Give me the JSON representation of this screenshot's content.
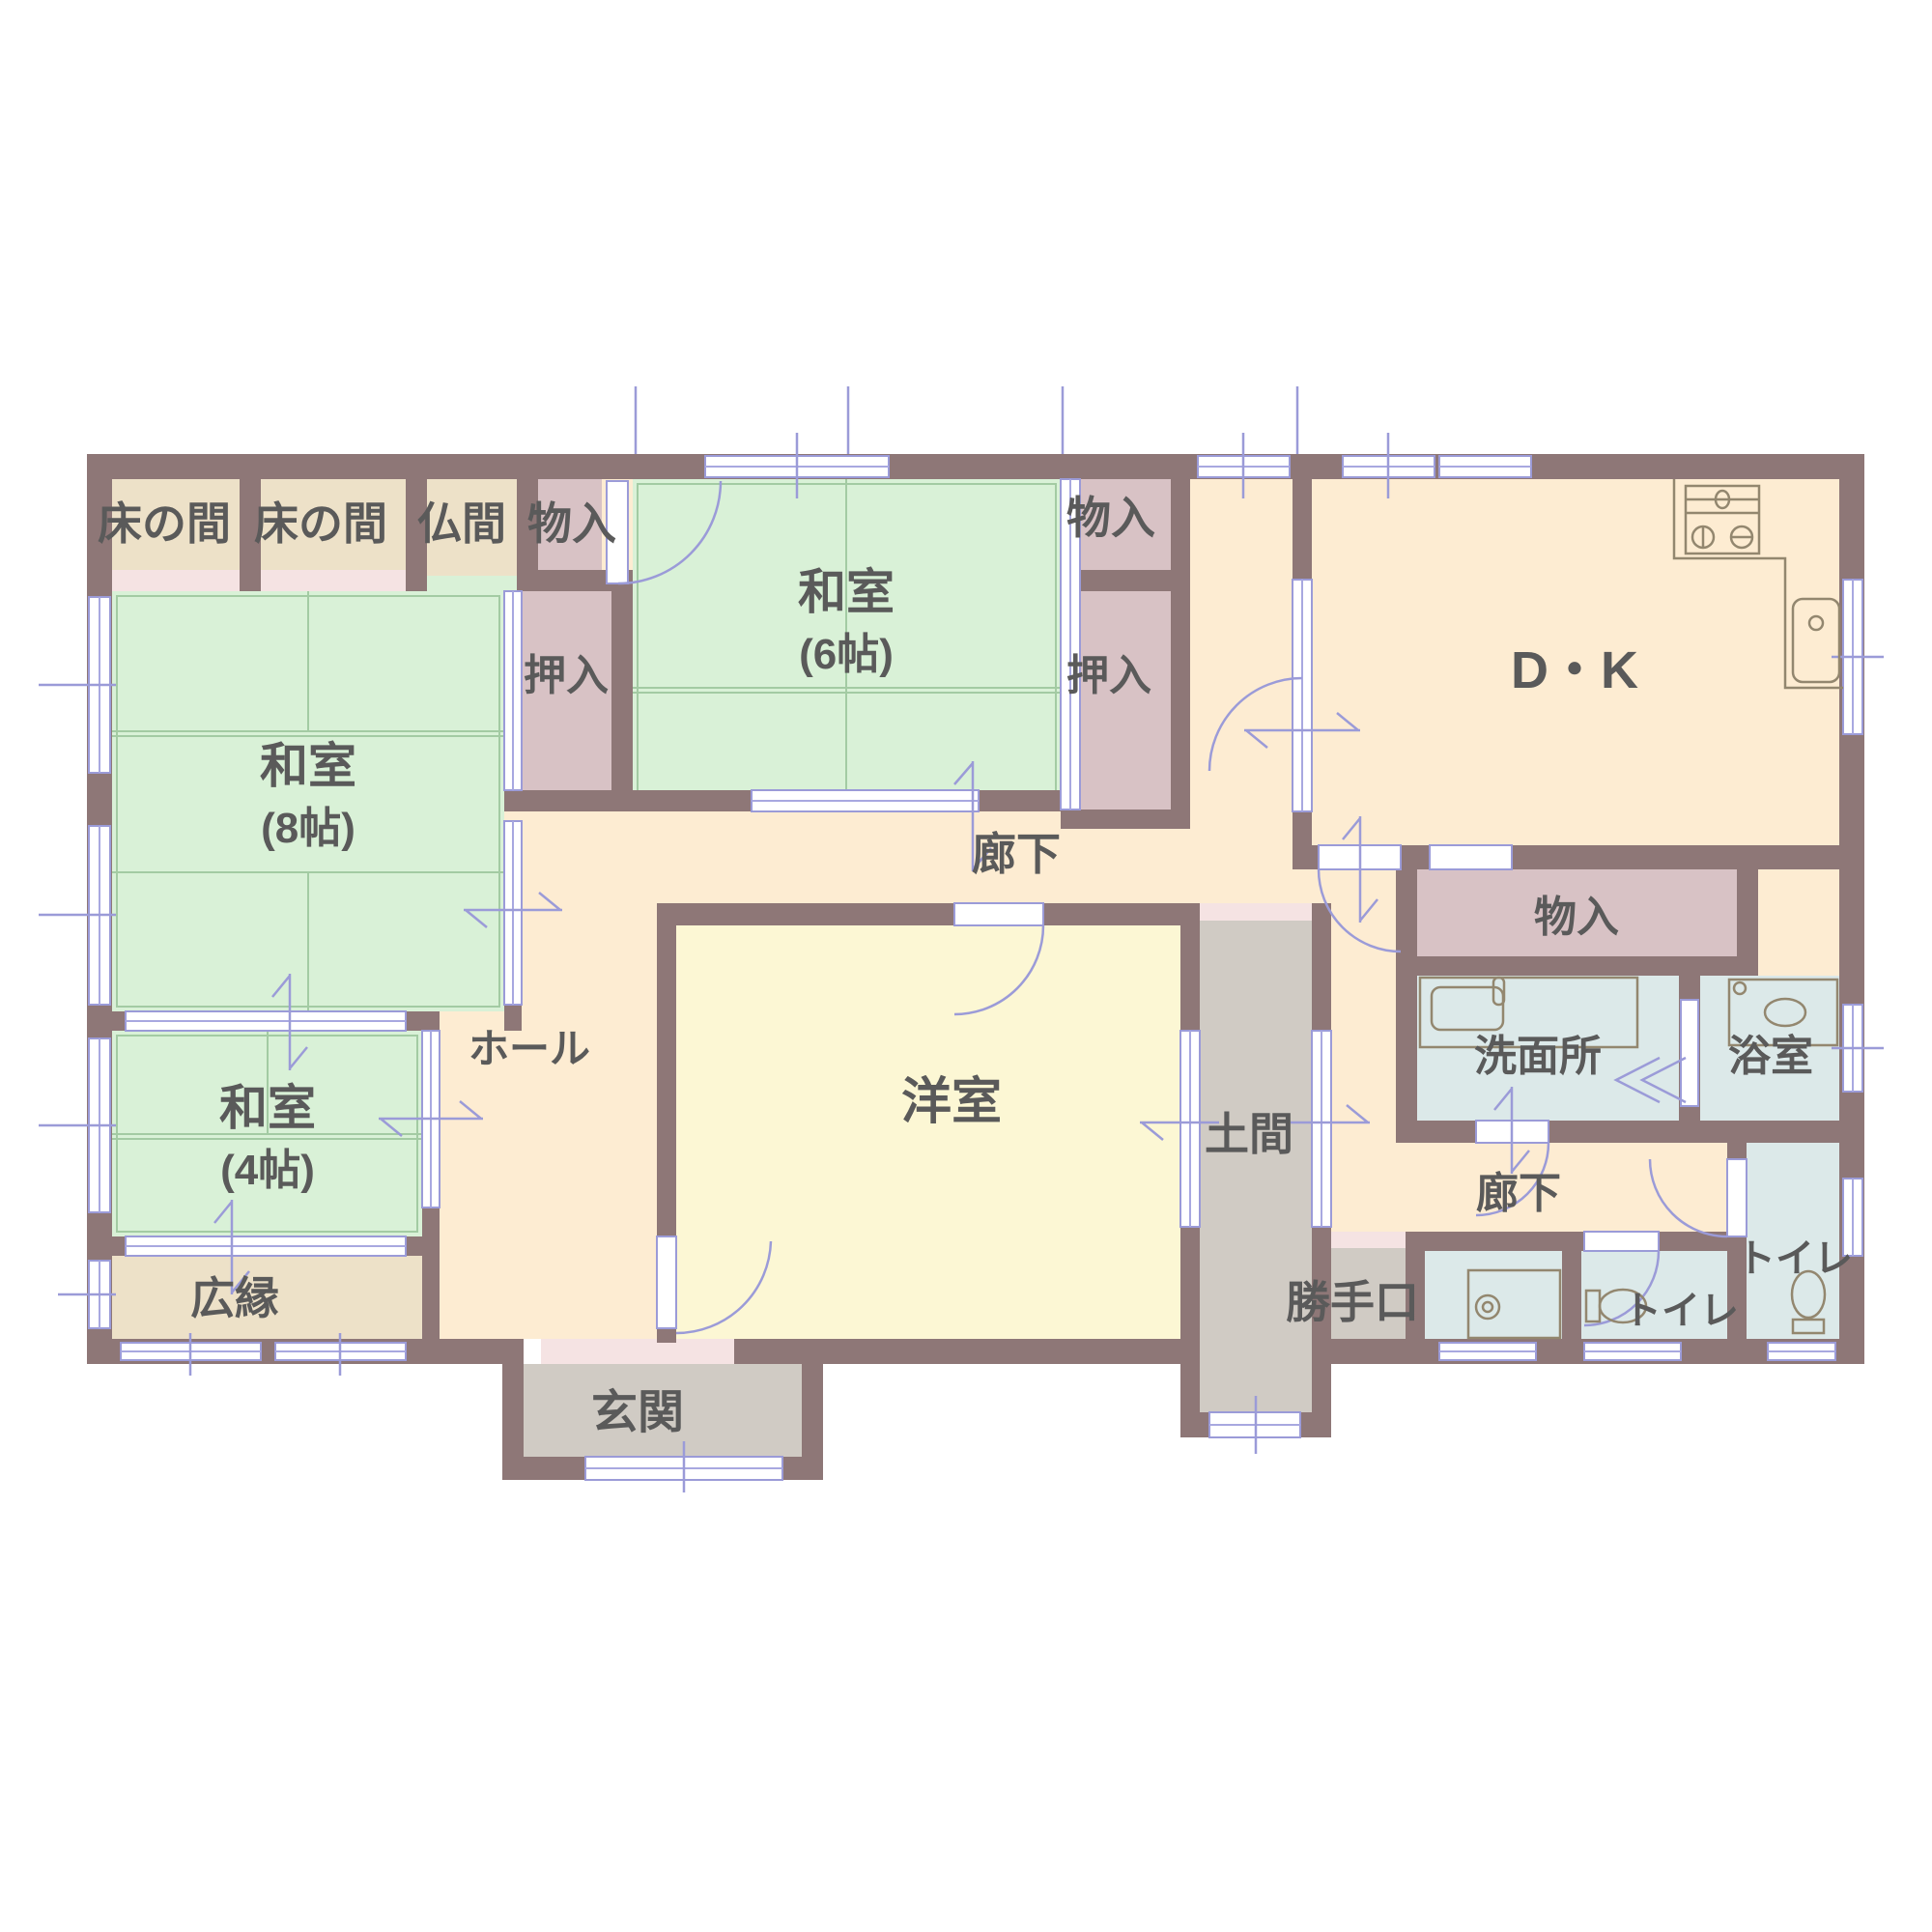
{
  "plan": {
    "type": "japanese-house-floor-plan",
    "text_color": "#5a5a5a",
    "colors": {
      "wall": "#8e7777",
      "tatami_green": "#d9f1d7",
      "tatami_grid": "#a3cba3",
      "corridor_peach": "#fdecd2",
      "western_room_yellow": "#fcf7d4",
      "closet_pink": "#d8c2c5",
      "alcove_beige": "#ede1c8",
      "step_pink": "#f5e3e3",
      "earth_floor_gray": "#d0cbc4",
      "wet_area_blue": "#dce9e9",
      "opening_white": "#ffffff",
      "symbol_blue": "#9b9bd8",
      "fixture_line": "#93876f"
    },
    "rooms": {
      "tokonoma_left": {
        "label": "床の間"
      },
      "tokonoma_right": {
        "label": "床の間"
      },
      "butsuma": {
        "label": "仏間"
      },
      "storage_top": {
        "label": "物入"
      },
      "washitsu_6": {
        "label": "和室",
        "size": "(6帖)"
      },
      "storage_mid": {
        "label": "物入"
      },
      "oshiire_left": {
        "label": "押入"
      },
      "oshiire_right": {
        "label": "押入"
      },
      "dining_kitchen": {
        "label": "D・K"
      },
      "corridor_main": {
        "label": "廊下"
      },
      "storage_dk": {
        "label": "物入"
      },
      "washitsu_8": {
        "label": "和室",
        "size": "(8帖)"
      },
      "hall": {
        "label": "ホール"
      },
      "western_room": {
        "label": "洋室"
      },
      "washroom": {
        "label": "洗面所"
      },
      "bathroom": {
        "label": "浴室"
      },
      "washitsu_4": {
        "label": "和室",
        "size": "(4帖)"
      },
      "doma": {
        "label": "土間"
      },
      "corridor_back": {
        "label": "廊下"
      },
      "hiroen": {
        "label": "広縁"
      },
      "kitchen_door": {
        "label": "勝手口"
      },
      "toilet_inner": {
        "label": "トイレ"
      },
      "toilet_outer": {
        "label": "トイレ"
      },
      "genkan": {
        "label": "玄関"
      }
    },
    "icons": [
      "gas-stove-icon",
      "kitchen-sink-icon",
      "washbasin-icon",
      "bathtub-icon",
      "washing-machine-icon",
      "toilet-icon",
      "toilet-icon"
    ]
  }
}
